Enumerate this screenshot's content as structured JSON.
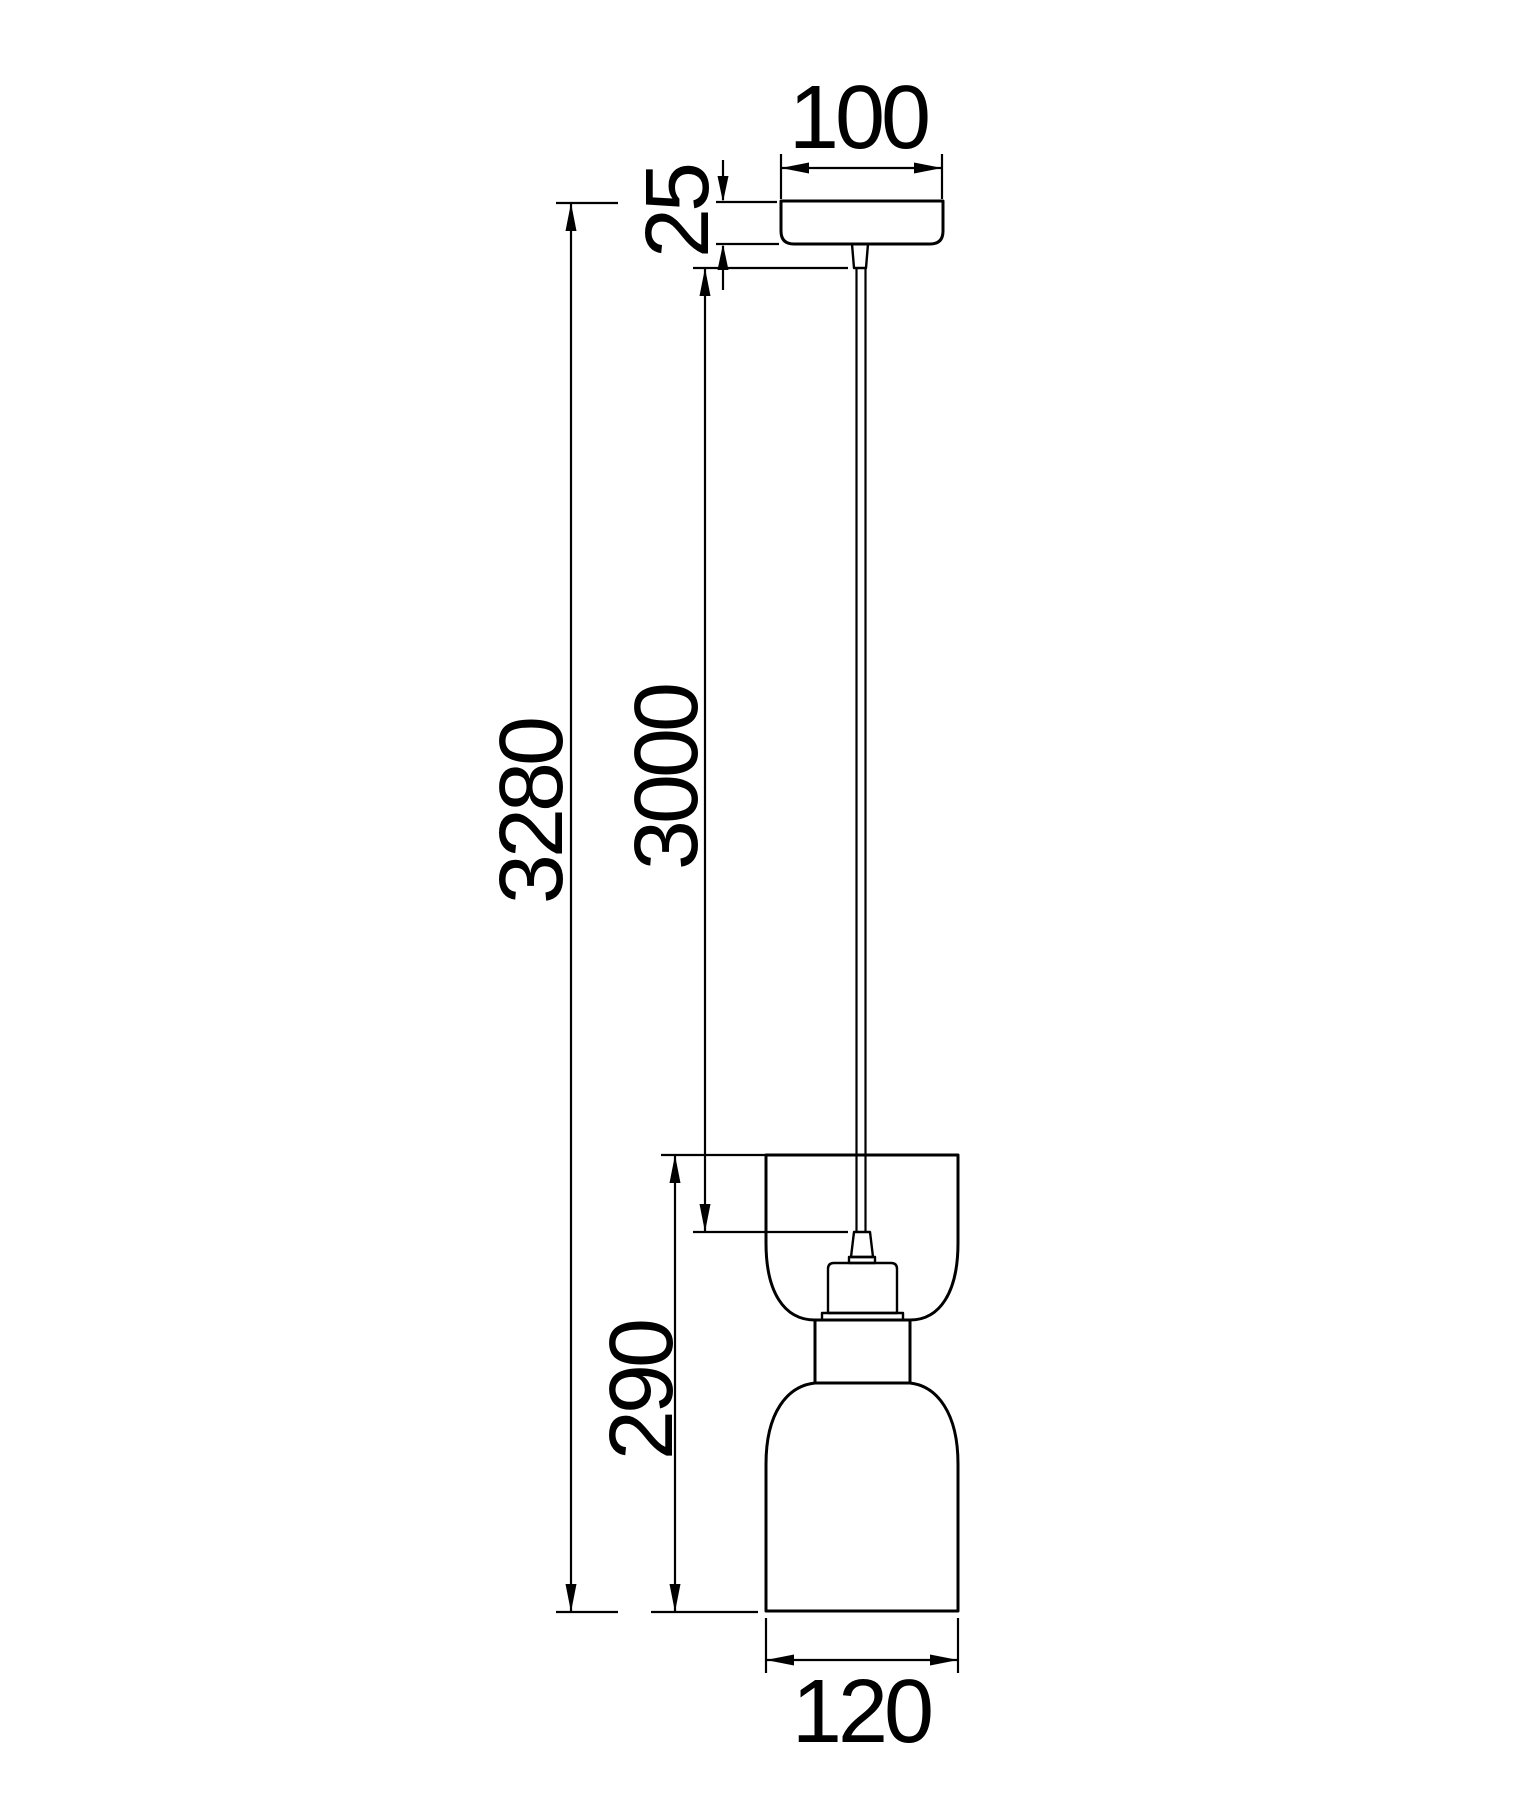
{
  "page": {
    "background": "#ffffff",
    "line_color": "#000000"
  },
  "drawing": {
    "labels": {
      "canopy_width": "100",
      "canopy_height": "25",
      "overall_drop": "3280",
      "cable_length": "3000",
      "shade_height": "290",
      "shade_diameter": "120"
    }
  }
}
